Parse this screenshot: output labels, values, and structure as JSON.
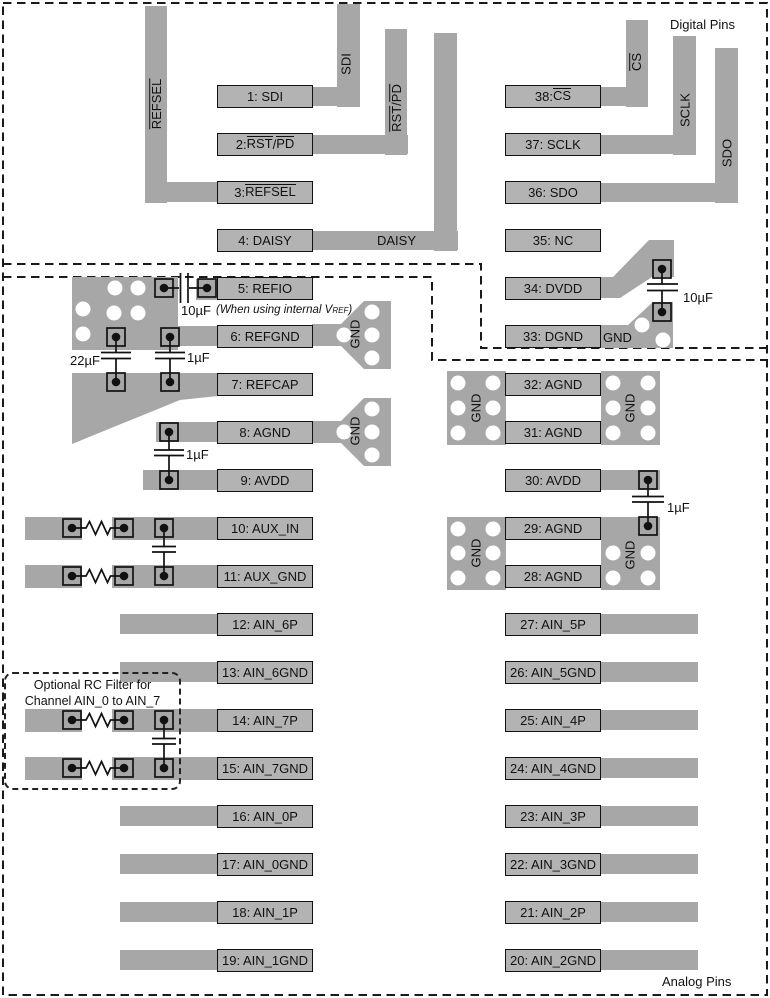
{
  "colors": {
    "trace": "#a7a7a7",
    "box_fill": "#b3b3b3",
    "line": "#111111",
    "background": "#ffffff"
  },
  "labels": {
    "digital": "Digital Pins",
    "analog": "Analog Pins",
    "gnd": "GND"
  },
  "caps": {
    "refio_10": "10µF",
    "ref_22": "22µF",
    "ref_1": "1µF",
    "agnd_1": "1µF",
    "dvdd_10": "10µF",
    "avdd_1": "1µF"
  },
  "notes": {
    "refio_pre": "(When using internal V",
    "refio_sub": "REF",
    "refio_post": ")",
    "rc_line1": "Optional RC Filter for",
    "rc_line2": "Channel AIN_0 to AIN_7"
  },
  "traces": {
    "refsel": [
      {
        "t": "REFSEL",
        "ov": true
      }
    ],
    "sdi": [
      {
        "t": "SDI"
      }
    ],
    "rstpd": [
      {
        "t": "RST",
        "ov": true
      },
      {
        "t": "/"
      },
      {
        "t": "PD",
        "ov": true
      }
    ],
    "daisy": [
      {
        "t": "DAISY"
      }
    ],
    "cs": [
      {
        "t": "CS",
        "ov": true
      }
    ],
    "sclk": [
      {
        "t": "SCLK"
      }
    ],
    "sdo": [
      {
        "t": "SDO"
      }
    ]
  },
  "left_pins": [
    {
      "id": "1",
      "parts": [
        {
          "t": "1: SDI"
        }
      ]
    },
    {
      "id": "2",
      "parts": [
        {
          "t": "2: "
        },
        {
          "t": "RST",
          "ov": true
        },
        {
          "t": "/"
        },
        {
          "t": "PD",
          "ov": true
        }
      ]
    },
    {
      "id": "3",
      "parts": [
        {
          "t": "3: "
        },
        {
          "t": "REFSEL",
          "ov": true
        }
      ]
    },
    {
      "id": "4",
      "parts": [
        {
          "t": "4: DAISY"
        }
      ]
    },
    {
      "id": "5",
      "parts": [
        {
          "t": "5: REFIO"
        }
      ]
    },
    {
      "id": "6",
      "parts": [
        {
          "t": "6: REFGND"
        }
      ]
    },
    {
      "id": "7",
      "parts": [
        {
          "t": "7: REFCAP"
        }
      ]
    },
    {
      "id": "8",
      "parts": [
        {
          "t": "8: AGND"
        }
      ]
    },
    {
      "id": "9",
      "parts": [
        {
          "t": "9: AVDD"
        }
      ]
    },
    {
      "id": "10",
      "parts": [
        {
          "t": "10: AUX_IN"
        }
      ]
    },
    {
      "id": "11",
      "parts": [
        {
          "t": "11: AUX_GND"
        }
      ]
    },
    {
      "id": "12",
      "parts": [
        {
          "t": "12: AIN_6P"
        }
      ]
    },
    {
      "id": "13",
      "parts": [
        {
          "t": "13: AIN_6GND"
        }
      ]
    },
    {
      "id": "14",
      "parts": [
        {
          "t": "14: AIN_7P"
        }
      ]
    },
    {
      "id": "15",
      "parts": [
        {
          "t": "15: AIN_7GND"
        }
      ]
    },
    {
      "id": "16",
      "parts": [
        {
          "t": "16: AIN_0P"
        }
      ]
    },
    {
      "id": "17",
      "parts": [
        {
          "t": "17: AIN_0GND"
        }
      ]
    },
    {
      "id": "18",
      "parts": [
        {
          "t": "18: AIN_1P"
        }
      ]
    },
    {
      "id": "19",
      "parts": [
        {
          "t": "19: AIN_1GND"
        }
      ]
    }
  ],
  "right_pins": [
    {
      "id": "38",
      "parts": [
        {
          "t": "38: "
        },
        {
          "t": "CS",
          "ov": true
        }
      ]
    },
    {
      "id": "37",
      "parts": [
        {
          "t": "37: SCLK"
        }
      ]
    },
    {
      "id": "36",
      "parts": [
        {
          "t": "36: SDO"
        }
      ]
    },
    {
      "id": "35",
      "parts": [
        {
          "t": "35: NC"
        }
      ]
    },
    {
      "id": "34",
      "parts": [
        {
          "t": "34: DVDD"
        }
      ]
    },
    {
      "id": "33",
      "parts": [
        {
          "t": "33: DGND"
        }
      ]
    },
    {
      "id": "32",
      "parts": [
        {
          "t": "32: AGND"
        }
      ]
    },
    {
      "id": "31",
      "parts": [
        {
          "t": "31: AGND"
        }
      ]
    },
    {
      "id": "30",
      "parts": [
        {
          "t": "30: AVDD"
        }
      ]
    },
    {
      "id": "29",
      "parts": [
        {
          "t": "29: AGND"
        }
      ]
    },
    {
      "id": "28",
      "parts": [
        {
          "t": "28: AGND"
        }
      ]
    },
    {
      "id": "27",
      "parts": [
        {
          "t": "27: AIN_5P"
        }
      ]
    },
    {
      "id": "26",
      "parts": [
        {
          "t": "26: AIN_5GND"
        }
      ]
    },
    {
      "id": "25",
      "parts": [
        {
          "t": "25: AIN_4P"
        }
      ]
    },
    {
      "id": "24",
      "parts": [
        {
          "t": "24: AIN_4GND"
        }
      ]
    },
    {
      "id": "23",
      "parts": [
        {
          "t": "23: AIN_3P"
        }
      ]
    },
    {
      "id": "22",
      "parts": [
        {
          "t": "22: AIN_3GND"
        }
      ]
    },
    {
      "id": "21",
      "parts": [
        {
          "t": "21: AIN_2P"
        }
      ]
    },
    {
      "id": "20",
      "parts": [
        {
          "t": "20: AIN_2GND"
        }
      ]
    }
  ]
}
